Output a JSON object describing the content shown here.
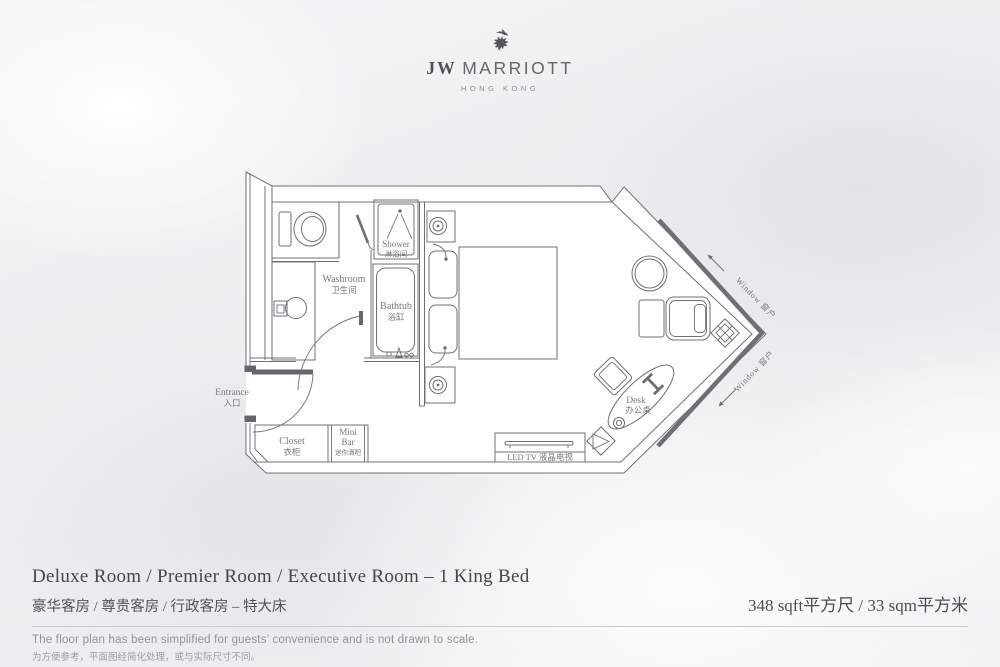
{
  "header": {
    "brand_jw": "JW",
    "brand_marriott": "MARRIOTT",
    "brand_location": "HONG KONG",
    "griffin_icon": "griffin-crest-icon"
  },
  "plan": {
    "labels": {
      "shower": {
        "en": "Shower",
        "zh": "淋浴间"
      },
      "washroom": {
        "en": "Washroom",
        "zh": "卫生间"
      },
      "bathtub": {
        "en": "Bathtub",
        "zh": "浴缸"
      },
      "entrance": {
        "en": "Entrance",
        "zh": "入口"
      },
      "closet": {
        "en": "Closet",
        "zh": "衣柜"
      },
      "minibar": {
        "en1": "Mini",
        "en2": "Bar",
        "zh": "迷你酒吧"
      },
      "desk": {
        "en": "Desk",
        "zh": "办公桌"
      },
      "tv": {
        "text": "LED TV 液晶电视"
      },
      "window_upper": {
        "text": "Window 窗户"
      },
      "window_lower": {
        "text": "Window 窗户"
      }
    }
  },
  "footer": {
    "title_en": "Deluxe Room / Premier Room / Executive Room – 1 King Bed",
    "title_zh": "豪华客房 / 尊贵客房 / 行政客房 – 特大床",
    "area": "348 sqft平方尺 / 33 sqm平方米",
    "disclaimer_en": "The floor plan has been simplified for guests’ convenience and is not drawn to scale.",
    "disclaimer_zh": "为方便参考，平面图经简化处理，或与实际尺寸不同。"
  },
  "colors": {
    "wall_line": "#6c7074",
    "window_band": "#6d7175",
    "label_text": "#74787c",
    "title_text": "#43474b",
    "muted_text": "#8f9396",
    "room_fill": "#ffffff"
  }
}
